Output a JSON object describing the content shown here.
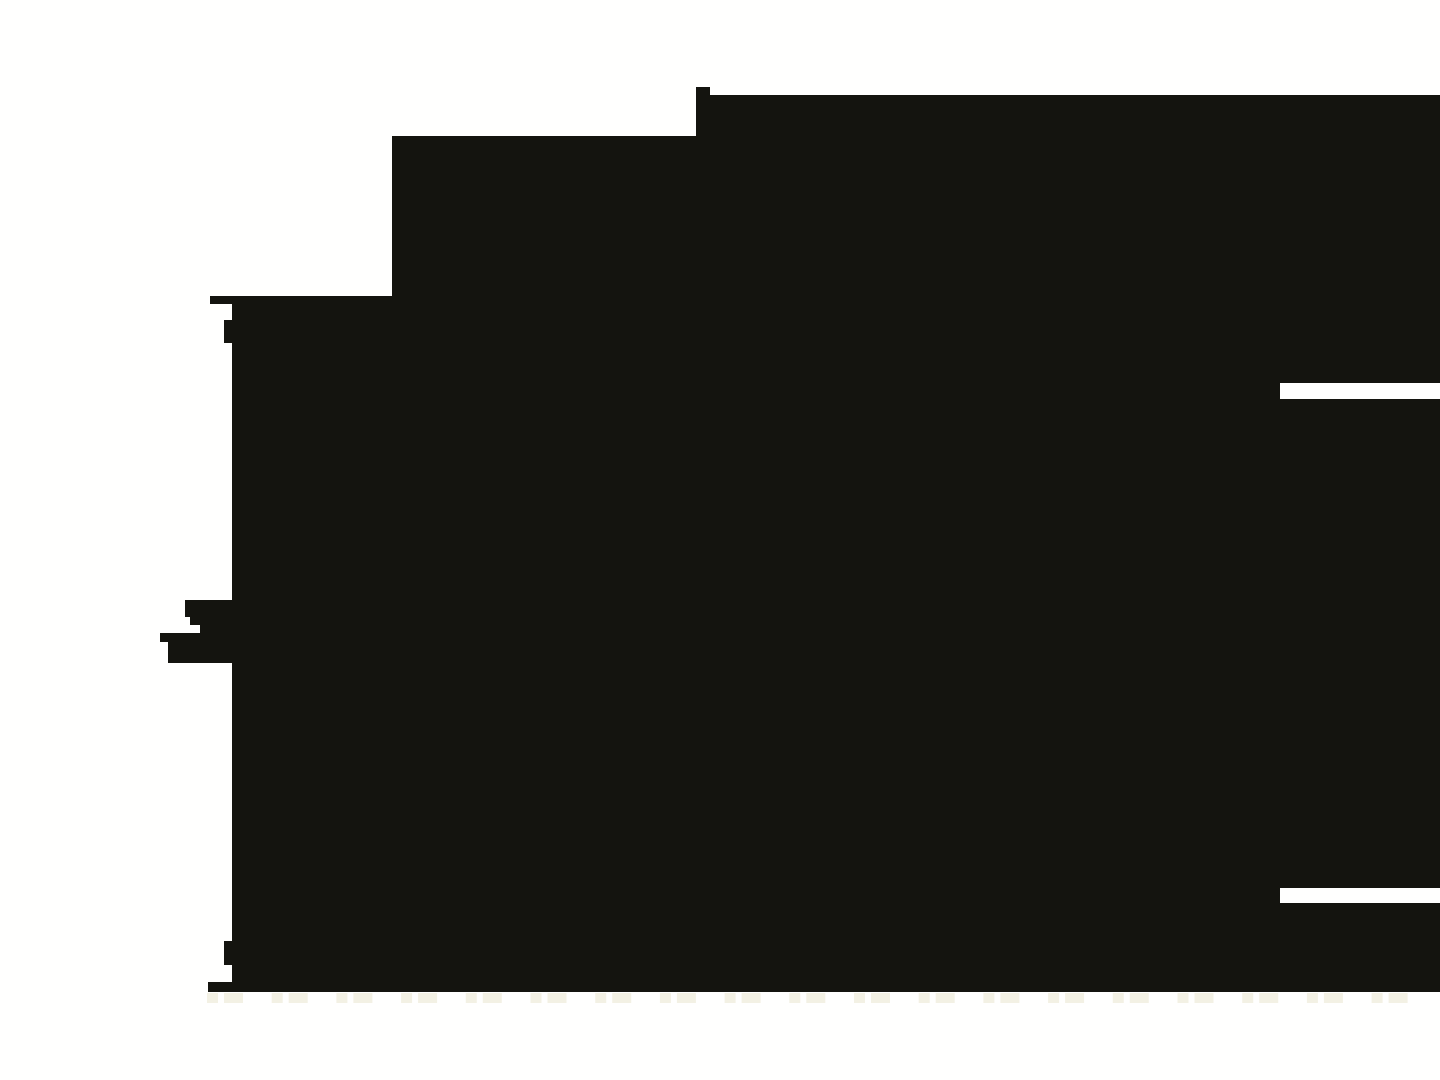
{
  "meta": {
    "description": "Binarized (thresholded) dark photograph: one large near-black silhouette blob on a white background, no visible text or UI controls",
    "image_width": 1440,
    "image_height": 1080
  },
  "canvas": {
    "width": 1440,
    "height": 1080,
    "background_color": "#FFFFFE",
    "ink_color": "#14140F",
    "faint_mark_color": "#F3F1E4"
  },
  "silhouette": {
    "main_polygon_points": "392,136 696,136 696,87 710,87 710,95 1440,95 1440,992 208,992 208,982 232,982 232,304 210,304 210,296 392,296",
    "left_edge_extension_rects": [
      {
        "x": 224,
        "y": 320,
        "w": 8,
        "h": 23
      },
      {
        "x": 185,
        "y": 600,
        "w": 47,
        "h": 17
      },
      {
        "x": 190,
        "y": 617,
        "w": 42,
        "h": 8
      },
      {
        "x": 200,
        "y": 625,
        "w": 32,
        "h": 8
      },
      {
        "x": 160,
        "y": 633,
        "w": 72,
        "h": 9
      },
      {
        "x": 168,
        "y": 642,
        "w": 64,
        "h": 21
      },
      {
        "x": 224,
        "y": 941,
        "w": 8,
        "h": 24
      }
    ],
    "white_slit_cutouts": [
      {
        "x": 1280,
        "y": 383,
        "w": 160,
        "h": 16
      },
      {
        "x": 1280,
        "y": 888,
        "w": 160,
        "h": 15
      }
    ]
  },
  "faint_marks_row": {
    "y": 993,
    "height": 10,
    "start_x": 207,
    "period": 64.7,
    "cluster_count": 19,
    "cluster_blocks": [
      {
        "dx": 0,
        "w": 11
      },
      {
        "dx": 17,
        "w": 19
      }
    ]
  }
}
